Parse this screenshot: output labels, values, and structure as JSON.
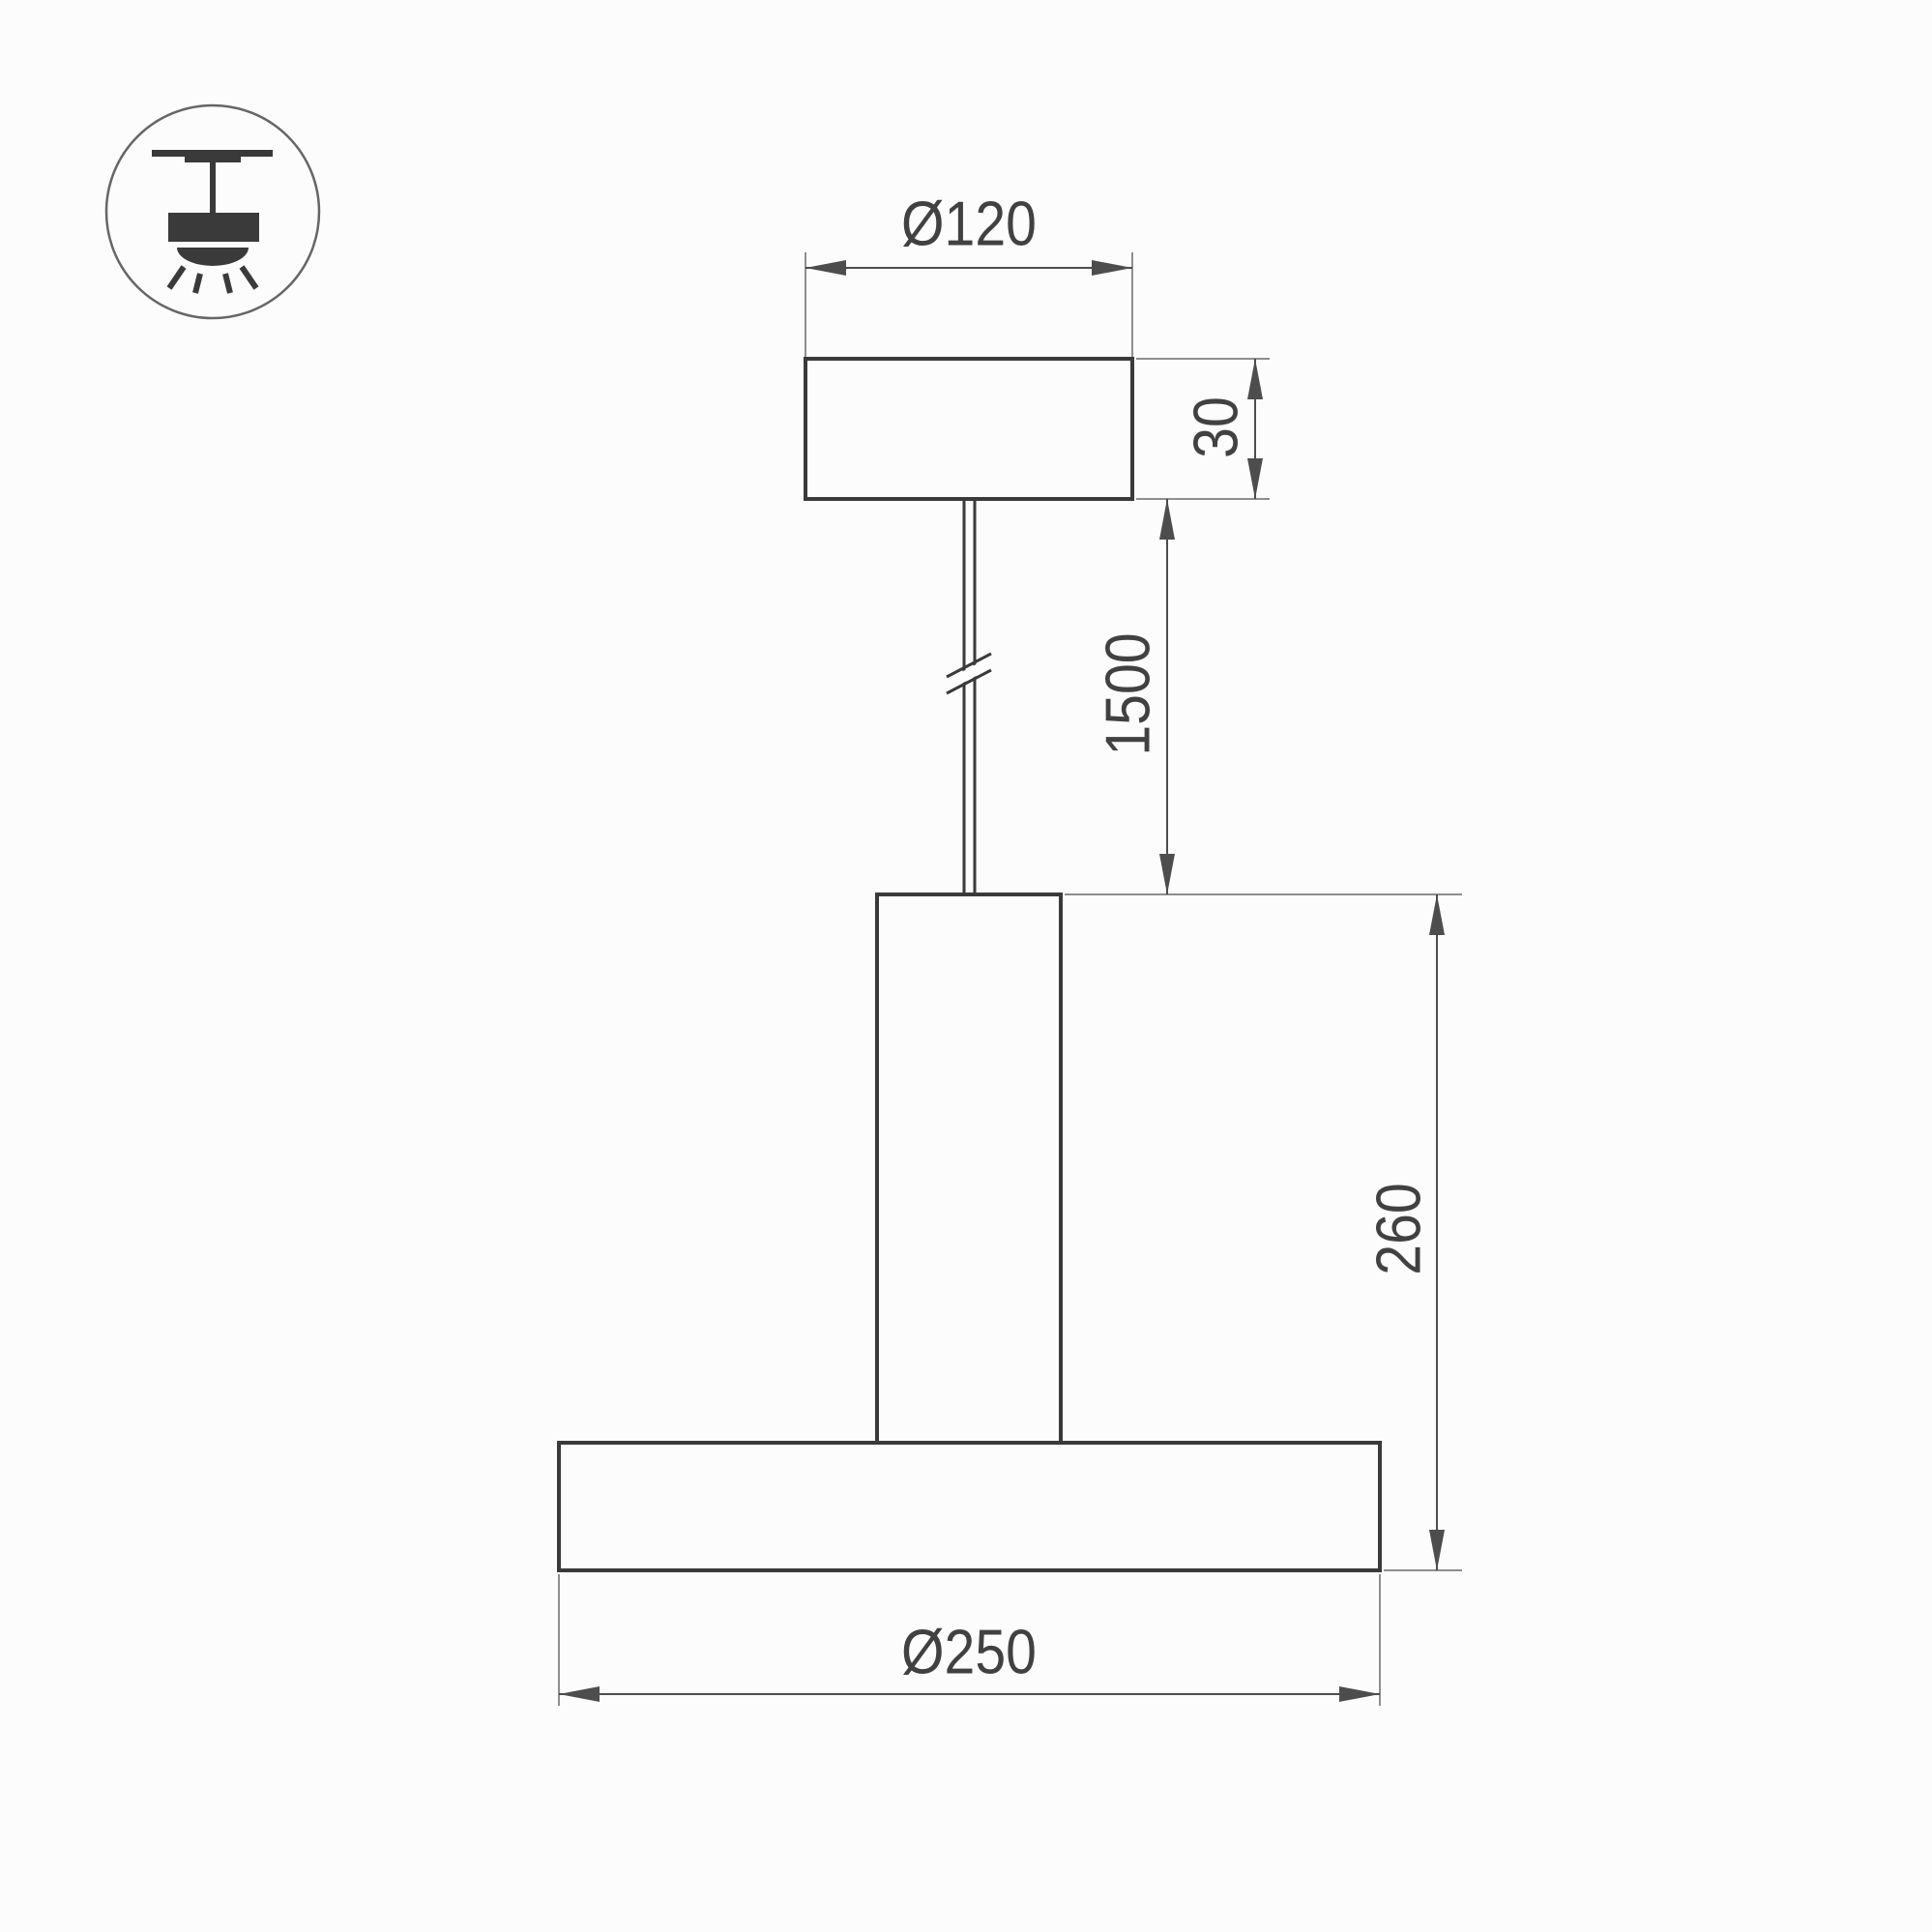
{
  "drawing": {
    "icon": "ceiling-pendant-lamp-icon",
    "dimensions": {
      "canopy_diameter": {
        "label": "Ø120",
        "value": 120,
        "orientation": "horizontal"
      },
      "canopy_height": {
        "label": "30",
        "value": 30,
        "orientation": "vertical"
      },
      "suspension_length": {
        "label": "1500",
        "value": 1500,
        "orientation": "vertical"
      },
      "body_height": {
        "label": "260",
        "value": 260,
        "orientation": "vertical"
      },
      "shade_diameter": {
        "label": "Ø250",
        "value": 250,
        "orientation": "horizontal"
      }
    },
    "colors": {
      "background": "#fcfcfc",
      "object_line": "#3a3a3a",
      "dimension_line": "#4d4d4d",
      "extension_line": "#8e8e8e",
      "text": "#414141"
    }
  }
}
